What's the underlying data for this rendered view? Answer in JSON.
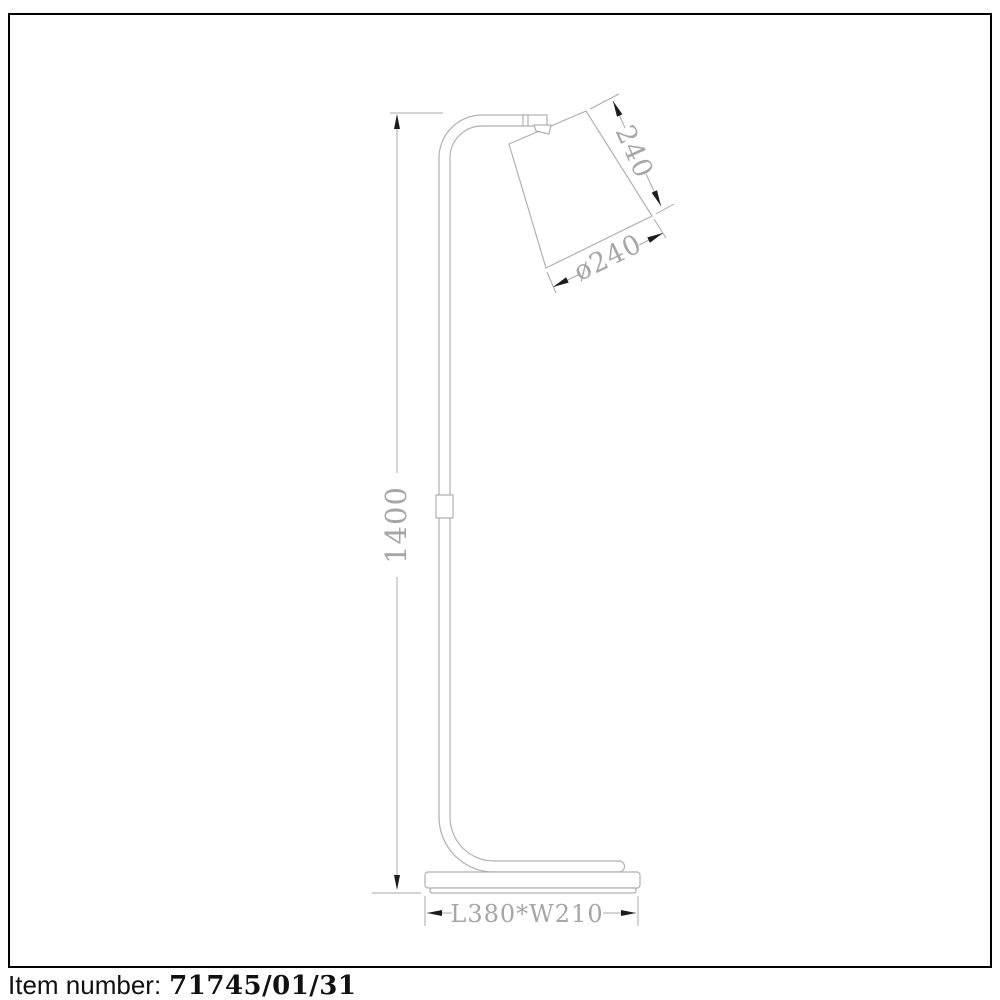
{
  "drawing": {
    "type": "technical-line-drawing",
    "subject": "floor lamp side view with dimensions",
    "colors": {
      "line": "#b0b0b0",
      "dim_line": "#a9a9a9",
      "dim_text": "#a6a6a6",
      "arrow": "#1c1c1c",
      "frame_border": "#000000"
    },
    "dimensions": {
      "height_mm": "1400",
      "shade_side_mm": "240",
      "shade_diameter_mm": "ø240",
      "base_size_mm": "L380*W210"
    }
  },
  "footer": {
    "label": "Item number:",
    "value": "71745/01/31"
  }
}
